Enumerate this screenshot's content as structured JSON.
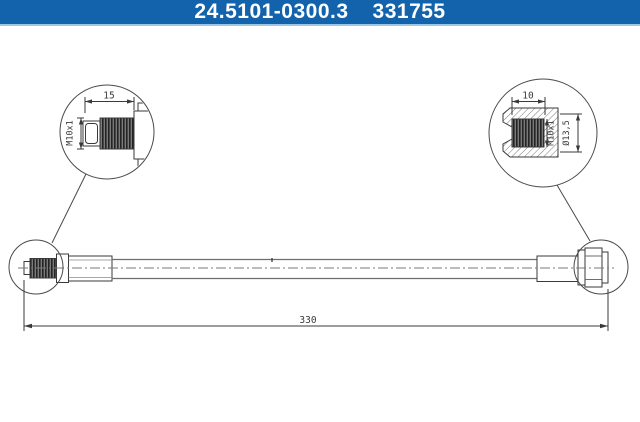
{
  "header": {
    "part_number": "24.5101-0300.3",
    "ean_number": "331755",
    "bg_color": "#1263ac",
    "text_color": "#ffffff"
  },
  "drawing": {
    "line_color": "#3a3a3a",
    "background_color": "#ffffff",
    "overall_length_label": "330",
    "left_detail": {
      "thread_length_label": "15",
      "thread_size_label": "M10x1"
    },
    "right_detail": {
      "thread_depth_label": "10",
      "thread_size_label": "M10x1",
      "diameter_label": "Ø13,5"
    }
  }
}
